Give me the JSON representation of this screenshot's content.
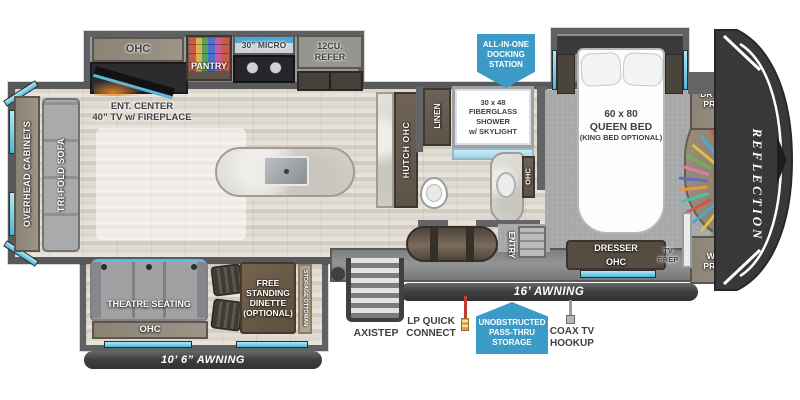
{
  "plan": {
    "brand_vertical": "REFLECTION"
  },
  "rear": {
    "overhead_cabinets": "OVERHEAD CABINETS",
    "tri_fold_sofa": "TRI-FOLD SOFA"
  },
  "kitchen": {
    "ohc": "OHC",
    "ent_center": "ENT. CENTER\n40” TV w/ FIREPLACE",
    "pantry": "PANTRY",
    "micro": "30” MICRO",
    "refer": "12CU.\nREFER"
  },
  "bath": {
    "hutch_ohc": "HUTCH OHC",
    "linen": "LINEN",
    "shower": "30 x 48\nFIBERGLASS\nSHOWER\nw/ SKYLIGHT",
    "vanity_ohc": "OHC",
    "entry": "ENTRY"
  },
  "bedroom": {
    "bed_size": "60 x 80",
    "bed_type": "QUEEN BED",
    "bed_option": "(KING BED OPTIONAL)",
    "dryer_prep": "DRYER\nPREP",
    "wd_prep": "W/D\nPREP",
    "dresser": "DRESSER",
    "dresser_ohc": "OHC",
    "tv_prep": "TV\nPREP"
  },
  "living": {
    "theatre_seating": "THEATRE SEATING",
    "ohc": "OHC",
    "dinette": "FREE\nSTANDING\nDINETTE\n(OPTIONAL)",
    "storage_ottoman": "STORAGE OTTOMAN"
  },
  "exterior": {
    "awning_living": "10’ 6” AWNING",
    "awning_main": "16’ AWNING",
    "axistep": "AXISTEP",
    "lp_quick_connect": "LP QUICK\nCONNECT",
    "coax_tv_hookup": "COAX TV\nHOOKUP",
    "docking_station": "ALL-IN-ONE\nDOCKING\nSTATION",
    "pass_thru": "UNOBSTRUCTED\nPASS-THRU\nSTORAGE"
  },
  "colors": {
    "badge_blue": "#3B9AC6",
    "awning_bar": "#414042",
    "window_cyan": "#5BC6E8",
    "hanger_colors": [
      "#d35454",
      "#4aa8d8",
      "#e0c04a",
      "#6cb05a",
      "#d97fb0",
      "#5a6fd0",
      "#e09a4a",
      "#4ac0ae",
      "#d35454",
      "#4aa8d8",
      "#e0c04a",
      "#6cb05a"
    ]
  }
}
